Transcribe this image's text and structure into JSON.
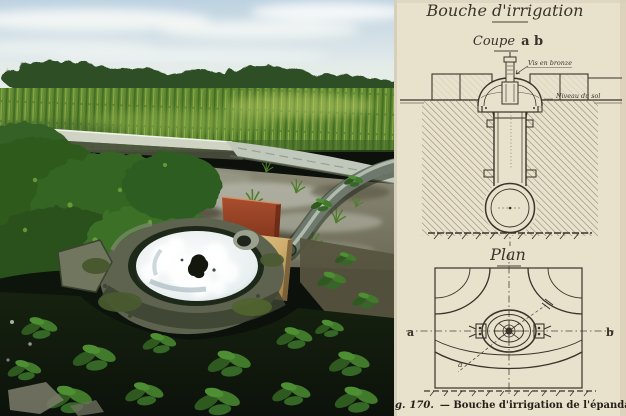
{
  "photo": {
    "description": "Colour photograph: irrigation bouche outlet bubbling white water into a round mossy concrete basin at the edge of a flooded corn field, with a grey layflat hose, a red panel and a plywood board, tree line and cloudy sky behind"
  },
  "diagram": {
    "title": "Bouche d'irrigation",
    "coupe": {
      "label": "Coupe",
      "points": "a b"
    },
    "annotations": {
      "screw": "Vis en bronze",
      "ground_level": "Niveau du sol"
    },
    "plan": {
      "label": "Plan",
      "marker_left": "a",
      "marker_right": "b",
      "marker_diagonal": "a"
    },
    "caption": {
      "prefix": "g.",
      "number": "170.",
      "rest": "— Bouche d'irrigation de l'épandage."
    }
  },
  "colors": {
    "paper": "#e8e1cc",
    "ink": "#3a332a",
    "caption-ink": "#241f17",
    "sky": "#bdd2e1",
    "tree": "#2f4f27",
    "corn": "#5c8530",
    "concrete": "#cfd3c3",
    "mud": "#8e8c78",
    "hose": "#6e786c",
    "board-red": "#a84f2e",
    "board-tan": "#cfae6e",
    "basin-stone": "#5e6350",
    "foam": "#e9eff0",
    "foreground": "#0c120b"
  }
}
